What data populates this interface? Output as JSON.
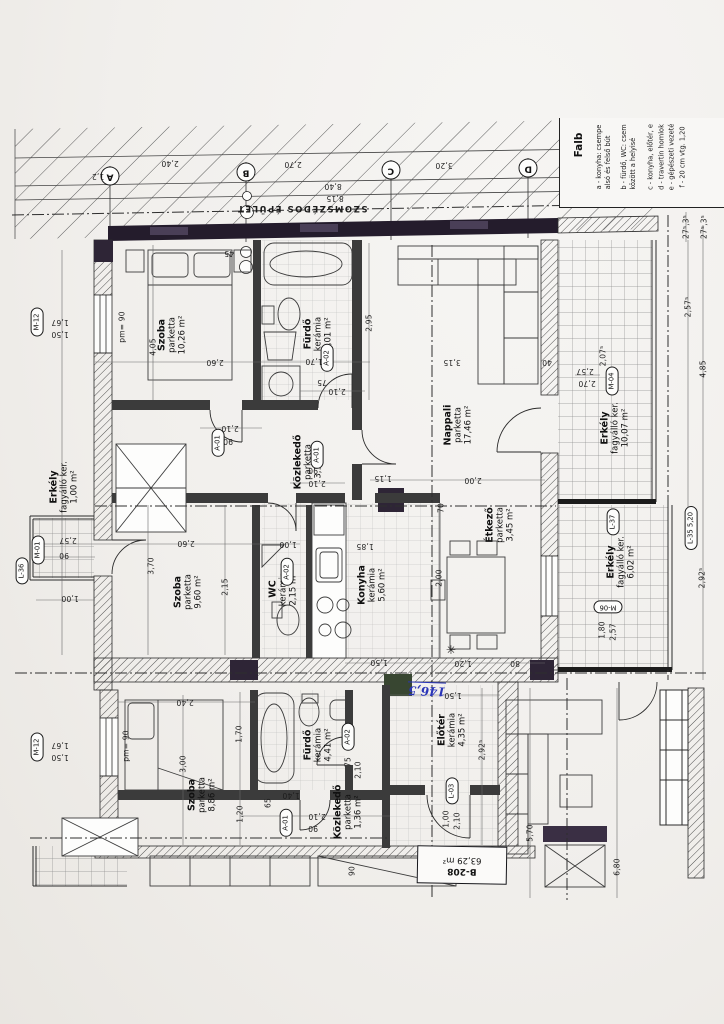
{
  "sheet": {
    "neighbor_label": "SZOMSZÉDOS ÉPÜLET",
    "handwritten_note": "146,5",
    "unit_box": {
      "id": "B-208",
      "area": "63,29 m²"
    }
  },
  "colors": {
    "paper": "#f1efec",
    "ink": "#2b2b2b",
    "dark_wall": "#241c2c",
    "block_purple": "#3a2f44",
    "block_green": "#34432f",
    "handwriting_blue": "#2a35b8"
  },
  "legend": {
    "title": "Falb",
    "items": [
      {
        "key": "a",
        "lines": [
          "a -  konyha: csempe",
          "alsó és felső bút"
        ],
        "x": 603,
        "y": 157
      },
      {
        "key": "b",
        "lines": [
          "b -  fürdő, WC: csem",
          "között a helyisé"
        ],
        "x": 628,
        "y": 157
      },
      {
        "key": "c",
        "lines": [
          "c -  konyha, előtér, e"
        ],
        "x": 650,
        "y": 157
      },
      {
        "key": "d",
        "lines": [
          "d -  travertin homlok"
        ],
        "x": 661,
        "y": 157
      },
      {
        "key": "e",
        "lines": [
          "e -  gépészeti vezeté"
        ],
        "x": 671,
        "y": 157
      },
      {
        "key": "f",
        "lines": [
          "f -  20 cm vtg. 1,20"
        ],
        "x": 682,
        "y": 157
      }
    ]
  },
  "grid_bubbles": [
    {
      "label": "A",
      "x": 110,
      "y": 176
    },
    {
      "label": "B",
      "x": 246,
      "y": 172
    },
    {
      "label": "C",
      "x": 391,
      "y": 170
    },
    {
      "label": "D",
      "x": 528,
      "y": 168
    }
  ],
  "rooms": [
    {
      "n": "Szoba",
      "f": "parketta",
      "a": "10,26 m²",
      "x": 172,
      "y": 335
    },
    {
      "n": "Fürdő",
      "f": "kerámia",
      "a": "5,01 m²",
      "x": 318,
      "y": 334
    },
    {
      "n": "Nappali",
      "f": "parketta",
      "a": "17,46 m²",
      "x": 458,
      "y": 425
    },
    {
      "n": "Közlekedő",
      "f": "parketta",
      "a": "3,15 m²",
      "x": 308,
      "y": 462
    },
    {
      "n": "Szoba",
      "f": "parketta",
      "a": "9,60 m²",
      "x": 188,
      "y": 592
    },
    {
      "n": "WC",
      "f": "kerámia",
      "a": "2,15 m²",
      "x": 283,
      "y": 589
    },
    {
      "n": "Konyha",
      "f": "kerámia",
      "a": "5,60 m²",
      "x": 372,
      "y": 585
    },
    {
      "n": "Étkező",
      "f": "parketta",
      "a": "3,45 m²",
      "x": 500,
      "y": 525
    },
    {
      "n": "Erkély",
      "f": "fagyálló ker.",
      "a": "1,00 m²",
      "x": 64,
      "y": 487
    },
    {
      "n": "Erkély",
      "f": "fagyálló ker.",
      "a": "10,07 m²",
      "x": 615,
      "y": 428
    },
    {
      "n": "Erkély",
      "f": "fagyálló ker.",
      "a": "6,02 m²",
      "x": 621,
      "y": 562
    },
    {
      "n": "Szoba",
      "f": "parketta",
      "a": "8,86 m²",
      "x": 202,
      "y": 795
    },
    {
      "n": "Fürdő",
      "f": "kerámia",
      "a": "4,41 m²",
      "x": 318,
      "y": 745
    },
    {
      "n": "Közlekedő",
      "f": "parketta",
      "a": "1,36 m²",
      "x": 348,
      "y": 812
    },
    {
      "n": "Előtér",
      "f": "kerámia",
      "a": "4,35 m²",
      "x": 452,
      "y": 730
    }
  ],
  "tags": [
    {
      "label": "M-12",
      "x": 37,
      "y": 322,
      "r": -90
    },
    {
      "label": "M-12",
      "x": 37,
      "y": 747,
      "r": -90
    },
    {
      "label": "M-01",
      "x": 38,
      "y": 550,
      "r": -90
    },
    {
      "label": "L-36",
      "x": 22,
      "y": 571,
      "r": -90
    },
    {
      "label": "A-01",
      "x": 218,
      "y": 443,
      "r": -90
    },
    {
      "label": "A-01",
      "x": 317,
      "y": 455,
      "r": -90
    },
    {
      "label": "A-02",
      "x": 327,
      "y": 358,
      "r": -90
    },
    {
      "label": "A-02",
      "x": 287,
      "y": 572,
      "r": -90
    },
    {
      "label": "A-01",
      "x": 286,
      "y": 823,
      "r": -90
    },
    {
      "label": "A-02",
      "x": 348,
      "y": 737,
      "r": -90
    },
    {
      "label": "L-03",
      "x": 452,
      "y": 791,
      "r": -90
    },
    {
      "label": "M-04",
      "x": 612,
      "y": 381,
      "r": -90
    },
    {
      "label": "L-37",
      "x": 613,
      "y": 522,
      "r": -90
    },
    {
      "label": "L-35  5,20",
      "x": 691,
      "y": 528,
      "r": -90
    },
    {
      "label": "M-06",
      "x": 608,
      "y": 607,
      "r": 180
    }
  ],
  "dimensions": [
    {
      "t": "2,40",
      "x": 170,
      "y": 163,
      "r": 180
    },
    {
      "t": "2,70",
      "x": 293,
      "y": 164,
      "r": 180
    },
    {
      "t": "3,20",
      "x": 444,
      "y": 165,
      "r": 180
    },
    {
      "t": "8,40",
      "x": 333,
      "y": 186,
      "r": 180
    },
    {
      "t": "8,15",
      "x": 335,
      "y": 198,
      "r": 180
    },
    {
      "t": "1,2",
      "x": 98,
      "y": 176,
      "r": 180
    },
    {
      "t": "1,67",
      "x": 60,
      "y": 322,
      "r": 180
    },
    {
      "t": "1,50",
      "x": 60,
      "y": 334,
      "r": 180
    },
    {
      "t": "pm= 90",
      "x": 122,
      "y": 327,
      "r": -90
    },
    {
      "t": "1,67",
      "x": 60,
      "y": 745,
      "r": 180
    },
    {
      "t": "1,50",
      "x": 60,
      "y": 757,
      "r": 180
    },
    {
      "t": "pm= 90",
      "x": 126,
      "y": 746,
      "r": -90
    },
    {
      "t": "2,57",
      "x": 68,
      "y": 540,
      "r": 180
    },
    {
      "t": "90",
      "x": 64,
      "y": 555,
      "r": 180
    },
    {
      "t": "1,00",
      "x": 70,
      "y": 598,
      "r": 180
    },
    {
      "t": "4,05",
      "x": 153,
      "y": 347,
      "r": -90
    },
    {
      "t": "2,60",
      "x": 215,
      "y": 362,
      "r": 180
    },
    {
      "t": "45",
      "x": 229,
      "y": 253,
      "r": 180
    },
    {
      "t": "2,95",
      "x": 369,
      "y": 323,
      "r": -90
    },
    {
      "t": "1,70",
      "x": 314,
      "y": 361,
      "r": 180
    },
    {
      "t": "75",
      "x": 322,
      "y": 382,
      "r": 180
    },
    {
      "t": "2,10",
      "x": 337,
      "y": 391,
      "r": 180
    },
    {
      "t": "2,10",
      "x": 230,
      "y": 428,
      "r": 180
    },
    {
      "t": "90",
      "x": 228,
      "y": 441,
      "r": 180
    },
    {
      "t": "2,10",
      "x": 317,
      "y": 483,
      "r": 180
    },
    {
      "t": "90",
      "x": 313,
      "y": 470,
      "r": 180
    },
    {
      "t": "3,15",
      "x": 452,
      "y": 362,
      "r": 180
    },
    {
      "t": "40",
      "x": 547,
      "y": 362,
      "r": 180
    },
    {
      "t": "2,00",
      "x": 473,
      "y": 480,
      "r": 180
    },
    {
      "t": "1,15",
      "x": 383,
      "y": 478,
      "r": 180
    },
    {
      "t": "70",
      "x": 441,
      "y": 508,
      "r": -90
    },
    {
      "t": "3,70",
      "x": 151,
      "y": 566,
      "r": -90
    },
    {
      "t": "2,60",
      "x": 186,
      "y": 543,
      "r": 180
    },
    {
      "t": "2,15",
      "x": 225,
      "y": 587,
      "r": -90
    },
    {
      "t": "1,00",
      "x": 288,
      "y": 544,
      "r": 180
    },
    {
      "t": "1,85",
      "x": 365,
      "y": 546,
      "r": 180
    },
    {
      "t": "2,00",
      "x": 439,
      "y": 578,
      "r": -90
    },
    {
      "t": "1,50",
      "x": 379,
      "y": 662,
      "r": 180
    },
    {
      "t": "1,20",
      "x": 463,
      "y": 663,
      "r": 180
    },
    {
      "t": "80",
      "x": 515,
      "y": 663,
      "r": 180
    },
    {
      "t": "✳",
      "x": 451,
      "y": 650,
      "r": 0,
      "big": true
    },
    {
      "t": "27⁵,3⁵",
      "x": 686,
      "y": 227,
      "r": -90
    },
    {
      "t": "27⁵,3⁵",
      "x": 704,
      "y": 227,
      "r": -90
    },
    {
      "t": "2,57",
      "x": 585,
      "y": 371,
      "r": 180
    },
    {
      "t": "2,70",
      "x": 587,
      "y": 383,
      "r": 180
    },
    {
      "t": "2,07⁵",
      "x": 603,
      "y": 356,
      "r": -90
    },
    {
      "t": "2,57⁵",
      "x": 688,
      "y": 307,
      "r": -90
    },
    {
      "t": "4,85",
      "x": 703,
      "y": 369,
      "r": -90
    },
    {
      "t": "2,92⁵",
      "x": 702,
      "y": 578,
      "r": -90
    },
    {
      "t": "1,80",
      "x": 602,
      "y": 630,
      "r": -90
    },
    {
      "t": "2,57",
      "x": 613,
      "y": 632,
      "r": -90
    },
    {
      "t": "2,40",
      "x": 185,
      "y": 702,
      "r": 180
    },
    {
      "t": "3,00",
      "x": 183,
      "y": 764,
      "r": -90
    },
    {
      "t": "1,70",
      "x": 239,
      "y": 734,
      "r": -90
    },
    {
      "t": "1,20",
      "x": 240,
      "y": 814,
      "r": -90
    },
    {
      "t": "1,40",
      "x": 291,
      "y": 795,
      "r": 180
    },
    {
      "t": "65",
      "x": 268,
      "y": 803,
      "r": -90
    },
    {
      "t": "2,10",
      "x": 317,
      "y": 816,
      "r": 180
    },
    {
      "t": "90",
      "x": 313,
      "y": 828,
      "r": 180
    },
    {
      "t": "75",
      "x": 348,
      "y": 762,
      "r": -90
    },
    {
      "t": "2,10",
      "x": 358,
      "y": 770,
      "r": -90
    },
    {
      "t": "1,50",
      "x": 453,
      "y": 695,
      "r": 180
    },
    {
      "t": "2,92⁵",
      "x": 482,
      "y": 750,
      "r": -90
    },
    {
      "t": "1,00",
      "x": 446,
      "y": 819,
      "r": -90
    },
    {
      "t": "2,10",
      "x": 457,
      "y": 821,
      "r": -90
    },
    {
      "t": "5,70",
      "x": 530,
      "y": 833,
      "r": -90
    },
    {
      "t": "6,80",
      "x": 617,
      "y": 867,
      "r": -90
    },
    {
      "t": "90",
      "x": 352,
      "y": 871,
      "r": -90
    }
  ]
}
